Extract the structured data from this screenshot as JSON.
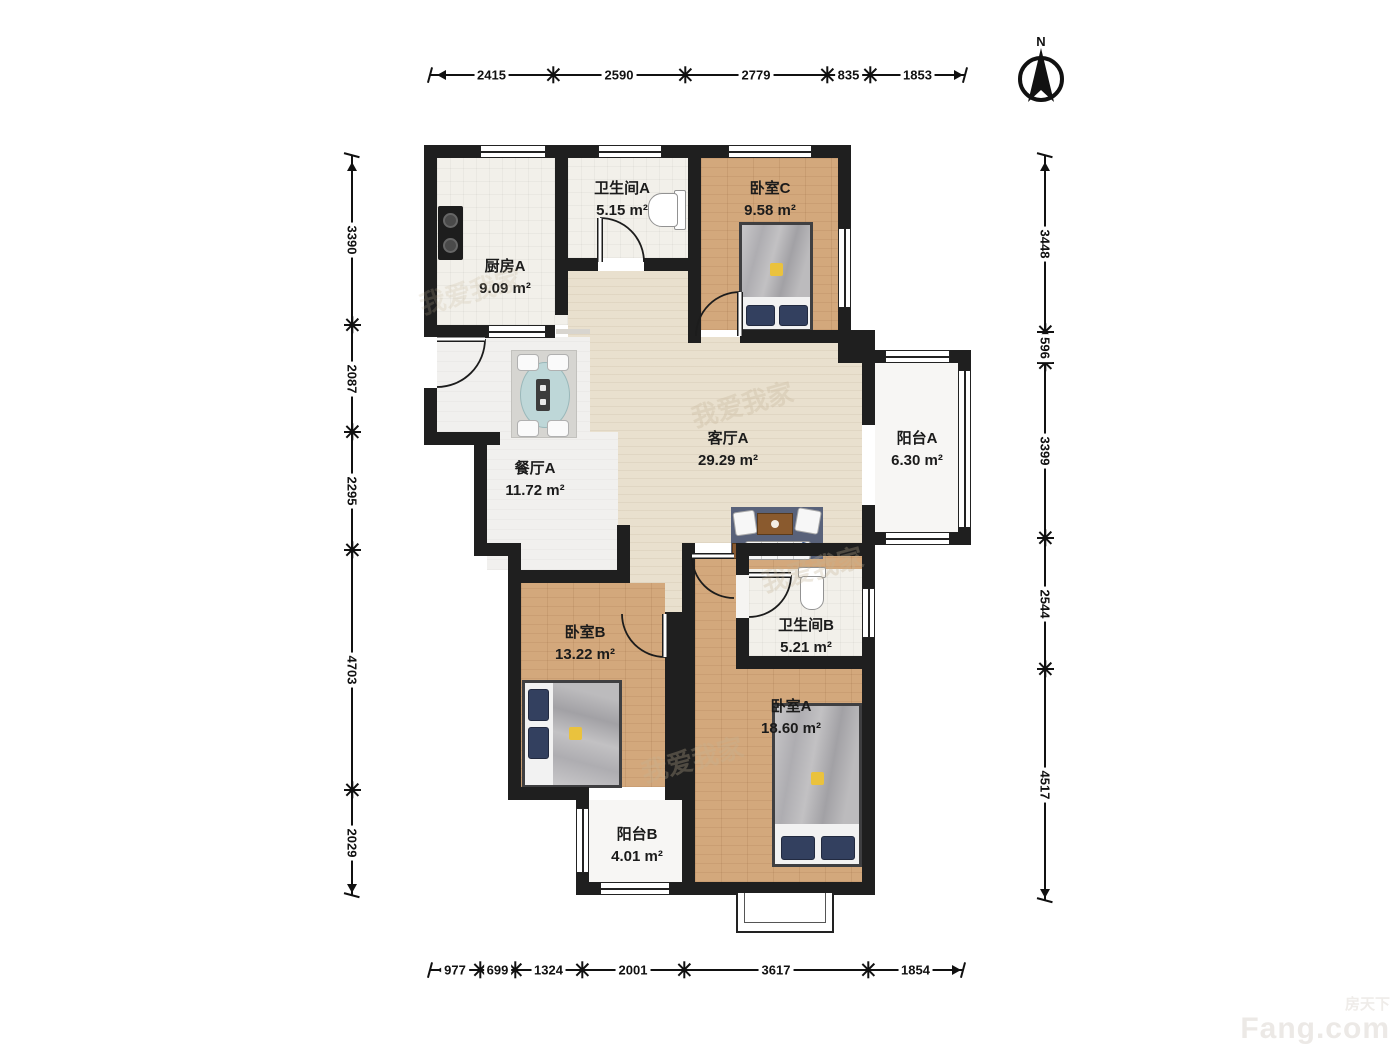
{
  "compass": {
    "label": "N"
  },
  "rooms": {
    "kitchenA": {
      "name": "厨房A",
      "area": "9.09 m²"
    },
    "bathA": {
      "name": "卫生间A",
      "area": "5.15 m²"
    },
    "bedC": {
      "name": "卧室C",
      "area": "9.58 m²"
    },
    "livingA": {
      "name": "客厅A",
      "area": "29.29 m²"
    },
    "balconyA": {
      "name": "阳台A",
      "area": "6.30 m²"
    },
    "diningA": {
      "name": "餐厅A",
      "area": "11.72 m²"
    },
    "bedB": {
      "name": "卧室B",
      "area": "13.22 m²"
    },
    "bathB": {
      "name": "卫生间B",
      "area": "5.21 m²"
    },
    "bedA": {
      "name": "卧室A",
      "area": "18.60 m²"
    },
    "balconyB": {
      "name": "阳台B",
      "area": "4.01 m²"
    }
  },
  "dimensions": {
    "top": [
      "2415",
      "2590",
      "2779",
      "835",
      "1853"
    ],
    "bottom": [
      "977",
      "699",
      "1324",
      "2001",
      "3617",
      "1854"
    ],
    "left": [
      "3390",
      "2087",
      "2295",
      "4703",
      "2029"
    ],
    "right": [
      "3448",
      "596",
      "3399",
      "2544",
      "4517"
    ]
  },
  "watermark": {
    "brand": "Fang.com",
    "brand_cn": "房天下",
    "faint": "我爱我家"
  },
  "colors": {
    "wall": "#1f1f1f",
    "wood_floor": "#d3a87c",
    "living_floor": "#e9e0ce",
    "bedding_navy": "#33405f",
    "accent_yellow": "#eac23d"
  }
}
